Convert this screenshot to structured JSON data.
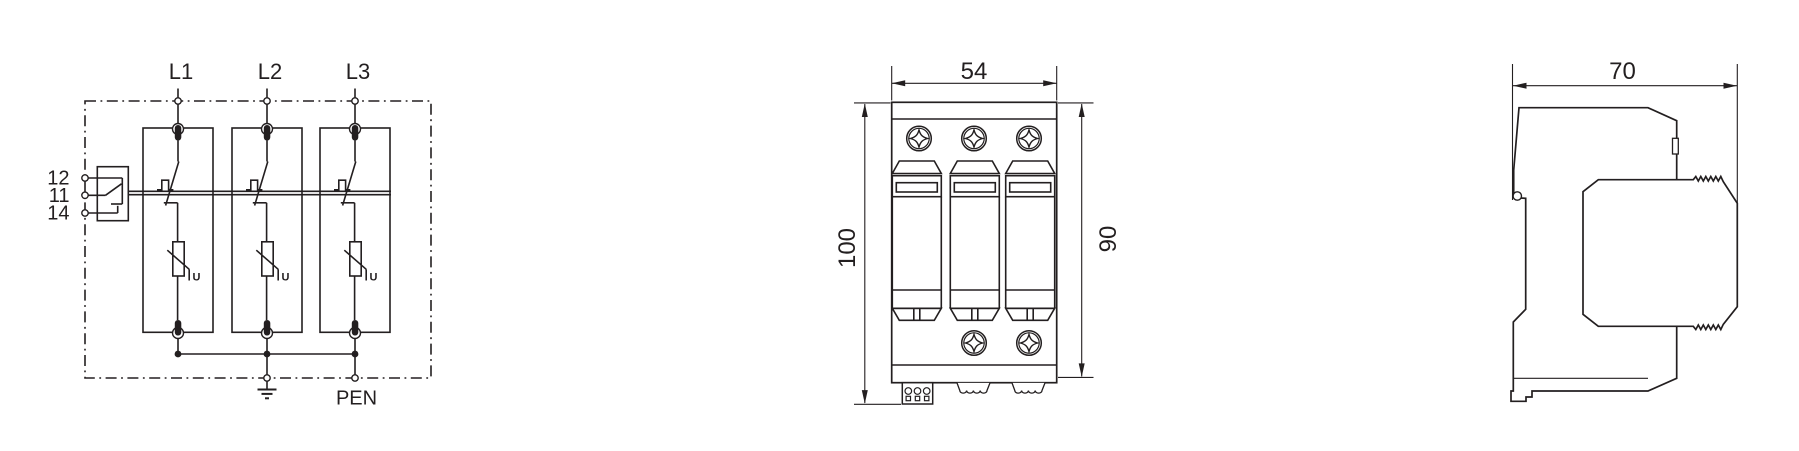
{
  "figure": {
    "circuit": {
      "phases": [
        "L1",
        "L2",
        "L3"
      ],
      "aux_terminals": [
        "12",
        "11",
        "14"
      ],
      "earth_label": "PEN",
      "varistor_voltage_label": "U"
    },
    "front_view": {
      "width": "54",
      "height_total": "100",
      "height_body": "90"
    },
    "side_view": {
      "depth": "70"
    },
    "colors": {
      "line": "#231f20",
      "background": "#ffffff"
    }
  }
}
